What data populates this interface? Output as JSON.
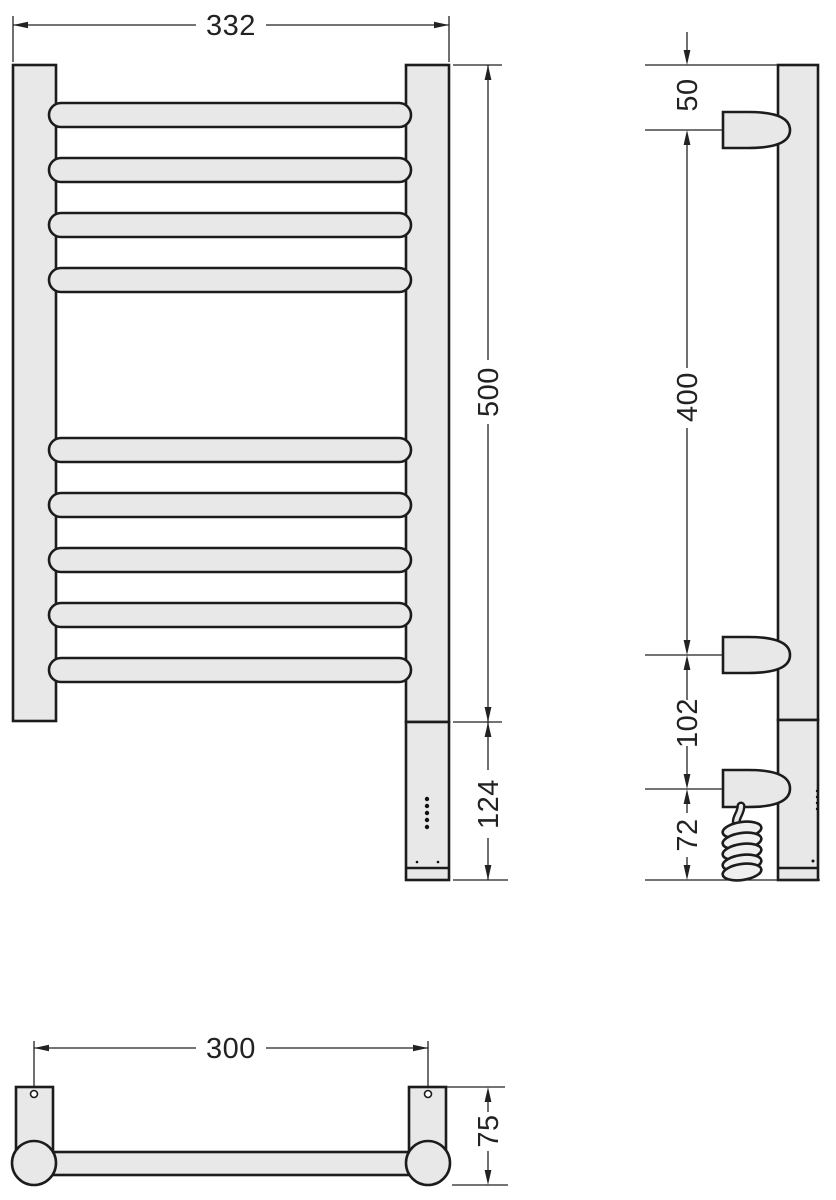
{
  "drawing": {
    "subject": "towel-radiator-dimension-drawing",
    "front": {
      "overall_width": "332",
      "overall_height": "500",
      "element_height": "124"
    },
    "side": {
      "top_bracket_offset": "50",
      "bracket_spacing": "400",
      "element_gap": "102",
      "element_bottom": "72"
    },
    "bottom": {
      "mounting_distance": "300",
      "depth": "75"
    },
    "colors": {
      "body_fill": "#e8e8e8",
      "outline": "#1c1c1c",
      "dimension_lines": "#222222",
      "background": "#ffffff"
    }
  }
}
